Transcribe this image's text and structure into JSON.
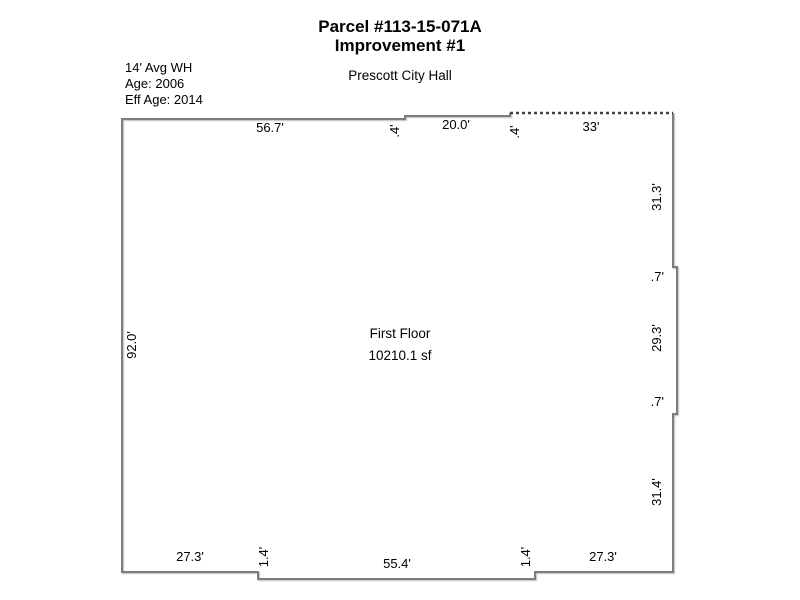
{
  "header": {
    "parcel_title": "Parcel #113-15-071A",
    "improvement_title": "Improvement #1",
    "building_name": "Prescott City Hall"
  },
  "info": {
    "wall_height": "14' Avg WH",
    "age": "Age: 2006",
    "eff_age": "Eff Age: 2014"
  },
  "floor": {
    "name": "First Floor",
    "area": "10210.1 sf"
  },
  "dims": {
    "top": [
      "56.7'",
      ".4'",
      "20.0'",
      ".4'",
      "33'"
    ],
    "right": [
      "31.3'",
      ".7'",
      "29.3'",
      ".7'",
      "31.4'"
    ],
    "bottom": [
      "27.3'",
      "1.4'",
      "55.4'",
      "1.4'",
      "27.3'"
    ],
    "left": [
      "92.0'"
    ]
  },
  "colors": {
    "outline": "#7d7d7d",
    "dashed_segment": "#404040",
    "dashed_dots": "#c9c9c9",
    "text": "#000000",
    "background": "#ffffff"
  }
}
